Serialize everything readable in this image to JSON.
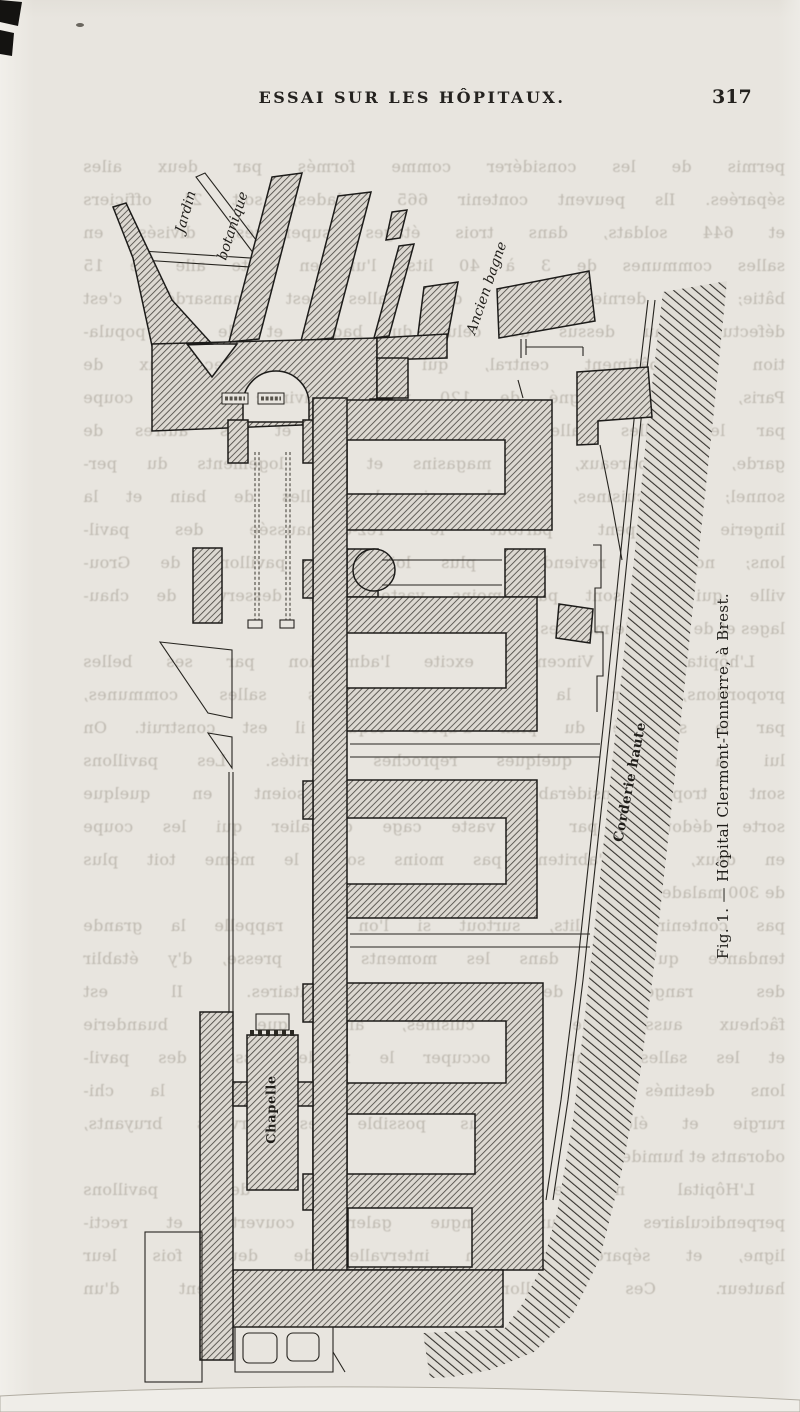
{
  "page": {
    "header_title": "ESSAI SUR LES HÔPITAUX.",
    "page_number": "317"
  },
  "figure": {
    "caption": "Fig. 1. — Hôpital Clermont-Tonnerre, à Brest.",
    "labels": {
      "jardin_line1": "Jardin",
      "jardin_line2": "botanique",
      "ancien_bagne": "Ancien bagne",
      "corderie_haute": "Corderie haute",
      "chapelle": "Chapelle"
    }
  },
  "bleedthrough": {
    "lines": [
      {
        "text": "permis de les considérer comme formés par deux ailes",
        "style": "full"
      },
      {
        "text": "séparées. Ils peuvent contenir 665 malades, soit 21 officiers",
        "style": "full"
      },
      {
        "text": "et 644 soldats, dans trois étages superposés, divisés en",
        "style": "full"
      },
      {
        "text": "salles communes de 3 à 40 lits, l'un en cette aile de 15",
        "style": "full"
      },
      {
        "text": "bâtie; le dernier étage des salles est mansardé; c'est",
        "style": "full"
      },
      {
        "text": "défectueux au dessus de celui du bagne et de la popula-",
        "style": "full"
      },
      {
        "text": "tion du bâtiment central, qui communique avec eux de",
        "style": "full"
      },
      {
        "text": "Paris, et est éloigné de 120 mètres environ; on le coupe",
        "style": "full"
      },
      {
        "text": "par les belles salles hautes, les unes et les autres de",
        "style": "full"
      },
      {
        "text": "garde, les bureaux, les magasins et les logements du per-",
        "style": "full"
      },
      {
        "text": "sonnel; les cuisines, la pharmacie, les salles de bain et la",
        "style": "full"
      },
      {
        "text": "lingerie occupent partout le rez-de-chaussée des pavil-",
        "style": "full"
      },
      {
        "text": "lons; nous y reviendrons plus loin. Les pavillons de Grou-",
        "style": "full"
      },
      {
        "text": "ville qui ne sont pas moins vastes sont desservis de chau-",
        "style": "full"
      },
      {
        "text": "lages et de salles de malades.",
        "style": "short"
      },
      {
        "text": "L'hôpital de Vincennes excite l'admiration par ses belles",
        "style": "indent"
      },
      {
        "text": "proportions, par la grandeur de ses salles communes,",
        "style": "full"
      },
      {
        "text": "par la salubrité du plan d'après lequel il est construit. On",
        "style": "full"
      },
      {
        "text": "lui a adressé quelques reproches mérités. Les pavillons",
        "style": "full"
      },
      {
        "text": "sont trop considérables pour qu'ils soient en quelque",
        "style": "full"
      },
      {
        "text": "sorte dédoublés par la vaste cage d'escalier qui les coupe",
        "style": "full"
      },
      {
        "text": "en deux, ils n'abritent pas moins sous le même toit plus",
        "style": "full"
      },
      {
        "text": "de 300 malades.",
        "style": "short"
      },
      {
        "text": "pas contenir 60 lits, surtout si l'on se rappelle la grande",
        "style": "full"
      },
      {
        "text": "tendance qu'on a, dans les moments de presse, d'y établir",
        "style": "full"
      },
      {
        "text": "des rangées de lits supplémentaires. Il est",
        "style": "full"
      },
      {
        "text": "fâcheux aussi que les cuisines, ainsi que la buanderie",
        "style": "full"
      },
      {
        "text": "et les salles aient dû occuper le rez-de-chaussée des pavil-",
        "style": "full"
      },
      {
        "text": "lons destinés aux malades; il faut réserver à la chi-",
        "style": "full"
      },
      {
        "text": "rurgie et éloigner le plus possible les services bruyants,",
        "style": "full"
      },
      {
        "text": "odorants et humides.",
        "style": "short"
      },
      {
        "text": "L'Hôpital militaire est formé de deux pavillons",
        "style": "indent"
      },
      {
        "text": "perpendiculaires à une longue galerie couverte et recti-",
        "style": "full"
      },
      {
        "text": "ligne, et séparés par un intervalle de deux fois leur",
        "style": "full"
      },
      {
        "text": "hauteur. Ces pavillons, construits élégamment d'un",
        "style": "full"
      }
    ]
  }
}
